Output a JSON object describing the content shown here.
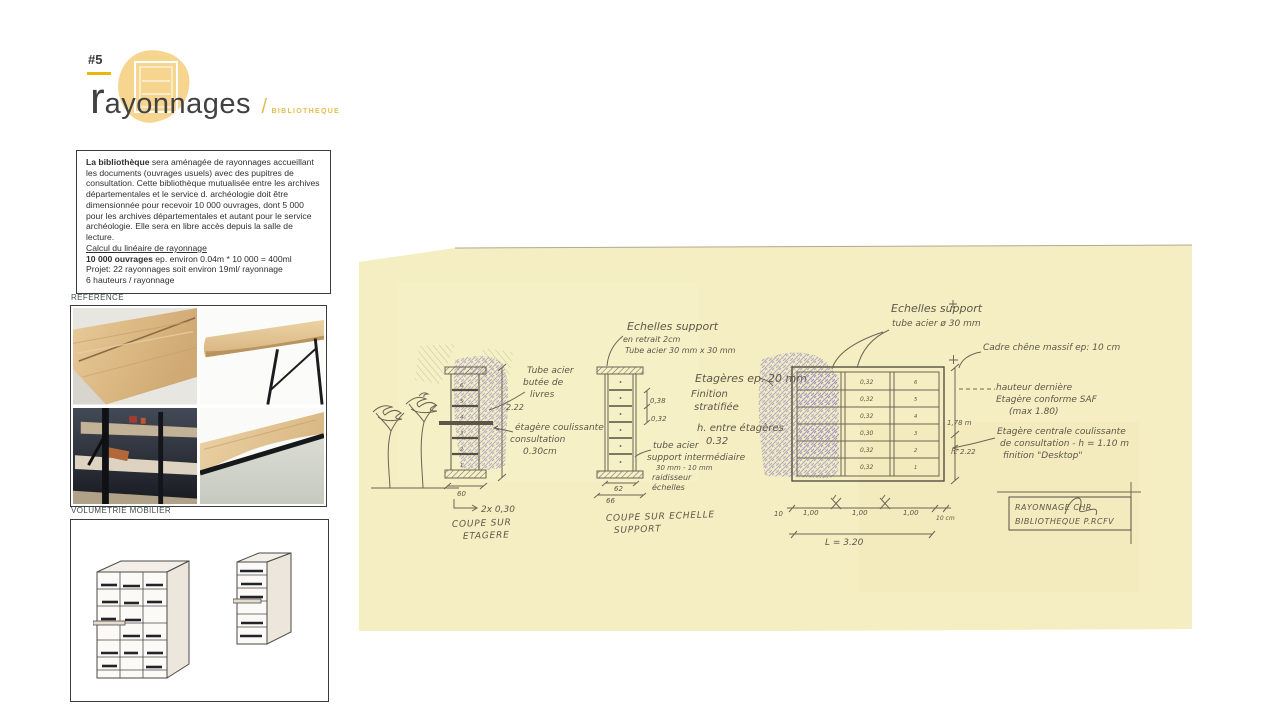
{
  "colors": {
    "accent_blob": "#f6d58f",
    "gold": "#e9b70f",
    "paper": "#f5eec2",
    "pencil": "#6b6455",
    "purple": "#9289c2"
  },
  "header": {
    "number": "#5",
    "title_initial": "r",
    "title_rest": "ayonnages",
    "separator": "/",
    "subtitle": "BIBLIOTHEQUE"
  },
  "intro": {
    "lead_bold": "La bibliothèque",
    "paragraph": " sera aménagée de rayonnages accueillant les documents (ouvrages usuels) avec des pupitres de consultation. Cette bibliothèque mutualisée entre les archives départementales et le service d.  archéologie doit être dimensionnée pour recevoir 10 000 ouvrages, dont 5 000 pour les archives départementales et autant pour le service archéologie. Elle sera en libre accès depuis la salle de lecture.",
    "calc_title": "Calcul du linéaire de rayonnage",
    "calc1_bold": "10 000 ouvrages",
    "calc1_rest": " ep. environ 0.04m * 10 000 = 400ml",
    "calc2": "Projet: 22 rayonnages soit environ 19ml/ rayonnage",
    "calc3": "6 hauteurs / rayonnage"
  },
  "sections": {
    "reference": "REFERENCE",
    "volumetrie": "VOLUMETRIE MOBILIER"
  },
  "sketch": {
    "left": {
      "ann_tube": [
        "Tube acier",
        "butée de",
        "livres"
      ],
      "dim_h": "2.22",
      "ann_slide": [
        "étagère coulissante",
        "consultation",
        "0.30cm"
      ],
      "dim_w": "60",
      "note": "2x 0,30",
      "caption": [
        "COUPE SUR",
        "ETAGERE"
      ],
      "nums": [
        "6",
        "5",
        "4",
        "3",
        "2",
        "1"
      ]
    },
    "middle": {
      "ann_top": [
        "Echelles support",
        "en retrait 2cm",
        "Tube acier 30 mm x 30 mm"
      ],
      "dim1": "0,38",
      "dim2": "0,32",
      "ann_tube": [
        "tube acier",
        "support intermédiaire",
        "30 mm - 10 mm",
        "raidisseur",
        "échelles"
      ],
      "ann_shelves": [
        "Etagères ep. 20 mm",
        "Finition",
        "stratifiée"
      ],
      "ann_h": [
        "h. entre étagères",
        "0.32"
      ],
      "dim_w1": "62",
      "dim_w2": "66",
      "caption": [
        "COUPE SUR ECHELLE",
        "SUPPORT"
      ]
    },
    "elev": {
      "ann_top": [
        "Echelles support",
        "tube acier ø 30 mm"
      ],
      "ann_frame": "Cadre chêne massif ep: 10 cm",
      "ann_conf": [
        "hauteur dernière",
        "Etagère conforme SAF",
        "(max 1.80)"
      ],
      "ann_slide": [
        "Etagère centrale coulissante",
        "de consultation - h = 1.10 m",
        "finition \"Desktop\""
      ],
      "dim_h1": "1,78 m",
      "dim_h2": "h: 2.22",
      "rows": [
        "0,32",
        "0,32",
        "0,32",
        "0,30",
        "0,32",
        "0,32"
      ],
      "nums": [
        "6",
        "5",
        "4",
        "3",
        "2",
        "1"
      ],
      "dims_bottom": [
        "10",
        "1,00",
        "1,00",
        "1,00",
        "10 cm"
      ],
      "dim_total": "L = 3.20",
      "block": [
        "RAYONNAGE   CHR",
        "BIBLIOTHEQUE  P.RCFV"
      ]
    }
  }
}
